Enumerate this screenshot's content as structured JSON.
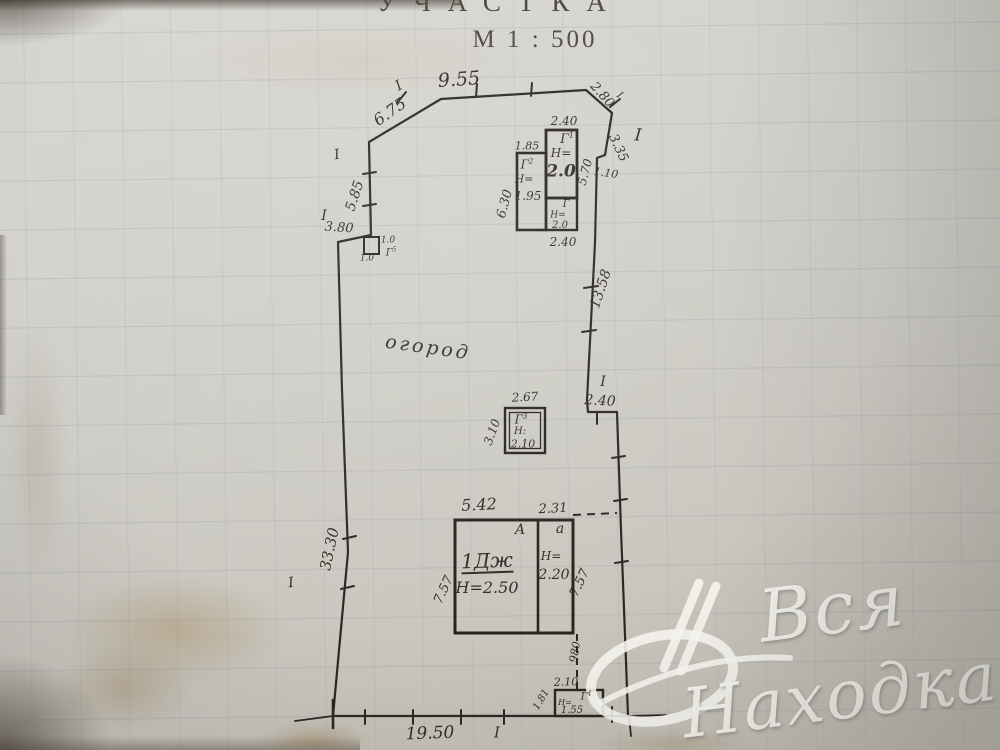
{
  "title": {
    "heading": "УЧАСТКА",
    "scale": "М 1 : 500"
  },
  "survey_marker": "I",
  "plot": {
    "garden_label": "огород",
    "dims": {
      "top_left_diag": "6.75",
      "top": "9.55",
      "top_right_diag": "2.80",
      "right_upper": "3.35",
      "right_jog": "1.10",
      "left_upper": "5.85",
      "left_step": "3.80",
      "right_main": "13.58",
      "right_step": "2.40",
      "left_main": "33.30",
      "bottom": "19.50"
    }
  },
  "buildings": {
    "g1": {
      "label": "Г",
      "sup": "1",
      "height_prefix": "Н=",
      "height": "2.0",
      "width_top": "2.40",
      "depth": "5.70",
      "width_bottom": "2.40"
    },
    "g2": {
      "label": "Г",
      "sup": "2",
      "height_prefix": "Н=",
      "height": "1.95",
      "width_top": "1.85",
      "depth": "6.30"
    },
    "g_annex": {
      "label": "Г",
      "height_prefix": "Н=",
      "height": "2.0"
    },
    "g3": {
      "label": "Г",
      "sup": "3",
      "height_prefix": "Н:",
      "height": "2.10",
      "width_top": "2.67",
      "depth": "3.10"
    },
    "g4": {
      "label": "Г",
      "sup": "4",
      "height_prefix": "Н=",
      "height": "1.55",
      "width_top": "2.10",
      "depth": "1.81",
      "gate_dim": "980"
    },
    "g5": {
      "label": "Г",
      "sup": "5",
      "dim_right": "1.0",
      "dim_bottom": "1.0"
    },
    "house": {
      "label": "1Дж",
      "height_note": "Н=2.50",
      "room_letter_big": "А",
      "room_letter_small": "а",
      "annex_height_prefix": "Н=",
      "annex_height": "2.20",
      "width_main": "5.42",
      "width_annex": "2.31",
      "depth_left": "7.57",
      "depth_right": "7.57"
    }
  },
  "watermark": {
    "word1": "Вся",
    "word2": "Находка"
  }
}
